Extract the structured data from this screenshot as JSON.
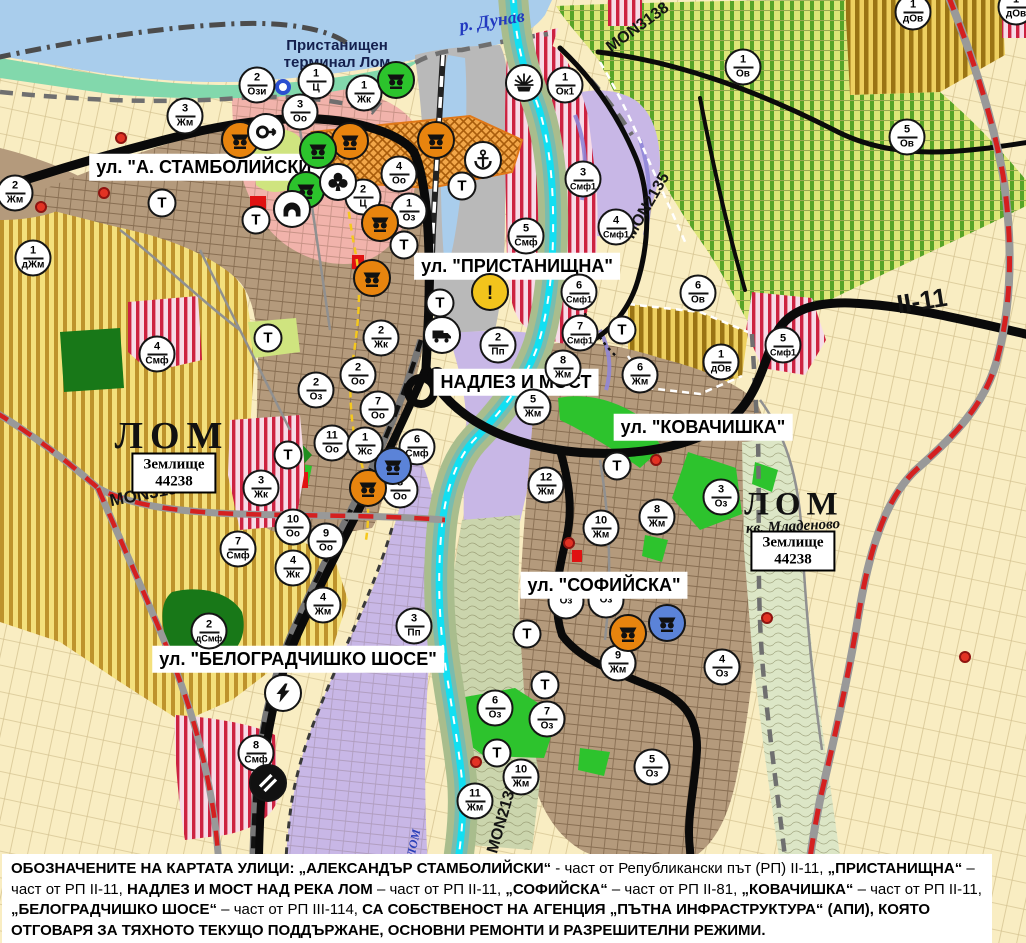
{
  "map": {
    "street_labels": [
      {
        "text": "ул. \"А. СТАМБОЛИЙСКИ\"",
        "x": 208,
        "y": 167
      },
      {
        "text": "ул. \"ПРИСТАНИЩНА\"",
        "x": 517,
        "y": 266
      },
      {
        "text": "НАДЛЕЗ И МОСТ",
        "x": 516,
        "y": 382
      },
      {
        "text": "ул. \"КОВАЧИШКА\"",
        "x": 703,
        "y": 427
      },
      {
        "text": "ул. \"СОФИЙСКА\"",
        "x": 604,
        "y": 585
      },
      {
        "text": "ул. \"БЕЛОГРАДЧИШКО ШОСЕ\"",
        "x": 298,
        "y": 659
      }
    ],
    "place_labels": [
      {
        "text": "р. Дунав",
        "x": 492,
        "y": 21,
        "rot": -9,
        "size": 18,
        "color": "#2239c0",
        "serif": true,
        "italic": true
      },
      {
        "text": "Пристанищен\nтерминал Лом",
        "x": 337,
        "y": 54,
        "rot": 0,
        "size": 15,
        "color": "#14204e",
        "serif": false,
        "italic": false
      },
      {
        "text": "ЛОМ",
        "x": 172,
        "y": 436,
        "rot": 0,
        "size": 38,
        "color": "#111111",
        "serif": true,
        "italic": false,
        "spacing": 7
      },
      {
        "text": "ЛОМ",
        "x": 794,
        "y": 505,
        "rot": 0,
        "size": 33,
        "color": "#111111",
        "serif": true,
        "italic": false,
        "spacing": 6
      },
      {
        "text": "кв. Младеново",
        "x": 793,
        "y": 527,
        "rot": -3,
        "size": 15,
        "color": "#111111",
        "serif": true,
        "italic": true
      },
      {
        "text": "ЛОМ",
        "x": 414,
        "y": 843,
        "rot": -78,
        "size": 12,
        "color": "#2a3fb8",
        "serif": true,
        "italic": true
      }
    ],
    "zemlishte_boxes": [
      {
        "lines": [
          "Землище",
          "44238"
        ],
        "x": 174,
        "y": 473
      },
      {
        "lines": [
          "Землище",
          "44238"
        ],
        "x": 793,
        "y": 551
      }
    ],
    "road_labels": [
      {
        "text": "MON3139",
        "x": 148,
        "y": 494,
        "rot": -11,
        "size": 17
      },
      {
        "text": "MON2135",
        "x": 648,
        "y": 206,
        "rot": -60,
        "size": 16
      },
      {
        "text": "MON3138",
        "x": 638,
        "y": 28,
        "rot": -36,
        "size": 16
      },
      {
        "text": "MON2136",
        "x": 503,
        "y": 818,
        "rot": -74,
        "size": 16
      },
      {
        "text": "II-11",
        "x": 922,
        "y": 301,
        "rot": -9,
        "size": 26
      }
    ],
    "t_label": "Т",
    "markers": [
      {
        "num": "2",
        "code": "Жм",
        "x": 15,
        "y": 193
      },
      {
        "num": "3",
        "code": "Жм",
        "x": 185,
        "y": 116
      },
      {
        "num": "2",
        "code": "Ози",
        "x": 257,
        "y": 85
      },
      {
        "num": "1",
        "code": "Ц",
        "x": 316,
        "y": 81
      },
      {
        "num": "3",
        "code": "Оо",
        "x": 300,
        "y": 112
      },
      {
        "num": "1",
        "code": "Жк",
        "x": 364,
        "y": 93
      },
      {
        "num": "1",
        "code": "Ок1",
        "x": 565,
        "y": 85
      },
      {
        "num": "1",
        "code": "дЖм",
        "x": 33,
        "y": 258
      },
      {
        "num": "4",
        "code": "Оо",
        "x": 399,
        "y": 174
      },
      {
        "num": "2",
        "code": "Ц",
        "x": 363,
        "y": 197
      },
      {
        "num": "1",
        "code": "Оз",
        "x": 409,
        "y": 211
      },
      {
        "num": "4",
        "code": "Смф",
        "x": 157,
        "y": 354
      },
      {
        "num": "5",
        "code": "Смф",
        "x": 526,
        "y": 236
      },
      {
        "num": "3",
        "code": "Смф1",
        "x": 583,
        "y": 179
      },
      {
        "num": "4",
        "code": "Смф1",
        "x": 616,
        "y": 227
      },
      {
        "num": "6",
        "code": "Смф1",
        "x": 579,
        "y": 292
      },
      {
        "num": "7",
        "code": "Смф1",
        "x": 580,
        "y": 333
      },
      {
        "num": "5",
        "code": "Смф1",
        "x": 783,
        "y": 345
      },
      {
        "num": "2",
        "code": "Жк",
        "x": 381,
        "y": 338
      },
      {
        "num": "2",
        "code": "Пп",
        "x": 498,
        "y": 345
      },
      {
        "num": "8",
        "code": "Жм",
        "x": 563,
        "y": 368
      },
      {
        "num": "5",
        "code": "Жм",
        "x": 533,
        "y": 407
      },
      {
        "num": "6",
        "code": "Жм",
        "x": 640,
        "y": 375
      },
      {
        "num": "12",
        "code": "Жм",
        "x": 546,
        "y": 485
      },
      {
        "num": "6",
        "code": "Смф",
        "x": 417,
        "y": 447
      },
      {
        "num": "8",
        "code": "Оо",
        "x": 400,
        "y": 490
      },
      {
        "num": "8",
        "code": "Жм",
        "x": 657,
        "y": 517
      },
      {
        "num": "10",
        "code": "Жм",
        "x": 601,
        "y": 528
      },
      {
        "num": "3",
        "code": "Оз",
        "x": 721,
        "y": 497
      },
      {
        "num": "2",
        "code": "Оз",
        "x": 316,
        "y": 390
      },
      {
        "num": "2",
        "code": "Оо",
        "x": 358,
        "y": 375
      },
      {
        "num": "7",
        "code": "Оо",
        "x": 378,
        "y": 409
      },
      {
        "num": "11",
        "code": "Оо",
        "x": 332,
        "y": 443
      },
      {
        "num": "1",
        "code": "Жс",
        "x": 365,
        "y": 445
      },
      {
        "num": "3",
        "code": "Жк",
        "x": 261,
        "y": 488
      },
      {
        "num": "10",
        "code": "Оо",
        "x": 293,
        "y": 527
      },
      {
        "num": "9",
        "code": "Оо",
        "x": 326,
        "y": 541
      },
      {
        "num": "4",
        "code": "Жк",
        "x": 293,
        "y": 568
      },
      {
        "num": "4",
        "code": "Жм",
        "x": 323,
        "y": 605
      },
      {
        "num": "2",
        "code": "дСмф",
        "x": 209,
        "y": 631
      },
      {
        "num": "7",
        "code": "Смф",
        "x": 238,
        "y": 549
      },
      {
        "num": "3",
        "code": "Пп",
        "x": 414,
        "y": 626
      },
      {
        "num": "8",
        "code": "Смф",
        "x": 256,
        "y": 753
      },
      {
        "num": "9",
        "code": "Жм",
        "x": 618,
        "y": 663
      },
      {
        "num": "4",
        "code": "Оз",
        "x": 722,
        "y": 667
      },
      {
        "num": "6",
        "code": "Оз",
        "x": 495,
        "y": 708
      },
      {
        "num": "7",
        "code": "Оз",
        "x": 547,
        "y": 719
      },
      {
        "num": "10",
        "code": "Жм",
        "x": 521,
        "y": 777
      },
      {
        "num": "11",
        "code": "Жм",
        "x": 475,
        "y": 801
      },
      {
        "num": "5",
        "code": "Оз",
        "x": 652,
        "y": 767
      },
      {
        "num": "1",
        "code": "Ов",
        "x": 743,
        "y": 67
      },
      {
        "num": "5",
        "code": "Ов",
        "x": 907,
        "y": 137
      },
      {
        "num": "6",
        "code": "Ов",
        "x": 698,
        "y": 293
      },
      {
        "num": "1",
        "code": "дОв",
        "x": 913,
        "y": 12
      },
      {
        "num": "1",
        "code": "дОв",
        "x": 721,
        "y": 362
      },
      {
        "num": "1",
        "code": "дОв",
        "x": 1016,
        "y": 7
      },
      {
        "num": "",
        "code": "Оз",
        "x": 566,
        "y": 601,
        "under": true
      },
      {
        "num": "",
        "code": "Оз",
        "x": 606,
        "y": 600,
        "under": true
      }
    ],
    "t_markers": [
      {
        "x": 162,
        "y": 203
      },
      {
        "x": 256,
        "y": 220
      },
      {
        "x": 268,
        "y": 338
      },
      {
        "x": 462,
        "y": 186
      },
      {
        "x": 404,
        "y": 245
      },
      {
        "x": 440,
        "y": 303
      },
      {
        "x": 622,
        "y": 330
      },
      {
        "x": 288,
        "y": 455
      },
      {
        "x": 617,
        "y": 466
      },
      {
        "x": 527,
        "y": 634
      },
      {
        "x": 545,
        "y": 685
      },
      {
        "x": 497,
        "y": 753
      }
    ],
    "icon_markers": [
      {
        "icon": "culture-monument",
        "fill": "#e8840e",
        "x": 240,
        "y": 140
      },
      {
        "icon": "culture-monument",
        "fill": "#e8840e",
        "x": 350,
        "y": 141
      },
      {
        "icon": "culture-monument",
        "fill": "#e8840e",
        "x": 436,
        "y": 140
      },
      {
        "icon": "culture-monument",
        "fill": "#e8840e",
        "x": 380,
        "y": 223
      },
      {
        "icon": "culture-monument",
        "fill": "#e8840e",
        "x": 372,
        "y": 278
      },
      {
        "icon": "culture-monument",
        "fill": "#e8840e",
        "x": 368,
        "y": 488
      },
      {
        "icon": "culture-monument",
        "fill": "#e8840e",
        "x": 628,
        "y": 633
      },
      {
        "icon": "culture-monument",
        "fill": "#2cc32c",
        "x": 396,
        "y": 80
      },
      {
        "icon": "culture-monument",
        "fill": "#2cc32c",
        "x": 318,
        "y": 150
      },
      {
        "icon": "culture-monument",
        "fill": "#2cc32c",
        "x": 306,
        "y": 190
      },
      {
        "icon": "culture-monument",
        "fill": "#5b83d8",
        "x": 393,
        "y": 466
      },
      {
        "icon": "culture-monument",
        "fill": "#5b83d8",
        "x": 667,
        "y": 623
      },
      {
        "icon": "circle-arrow",
        "fill": "#ffffff",
        "x": 266,
        "y": 132
      },
      {
        "icon": "cloverleaf",
        "fill": "#ffffff",
        "x": 338,
        "y": 182
      },
      {
        "icon": "tunnel",
        "fill": "#ffffff",
        "x": 292,
        "y": 209
      },
      {
        "icon": "anchor",
        "fill": "#ffffff",
        "x": 483,
        "y": 160
      },
      {
        "icon": "sun-rays",
        "fill": "#ffffff",
        "x": 524,
        "y": 83
      },
      {
        "icon": "warning",
        "fill": "#f2c41c",
        "x": 490,
        "y": 292
      },
      {
        "icon": "truck",
        "fill": "#ffffff",
        "x": 442,
        "y": 335
      },
      {
        "icon": "lightning",
        "fill": "#ffffff",
        "x": 283,
        "y": 693
      },
      {
        "icon": "rail-crossing",
        "fill": "#111111",
        "x": 268,
        "y": 783
      }
    ],
    "small_symbols": [
      {
        "type": "blue-ring",
        "x": 283,
        "y": 87
      },
      {
        "type": "red-dot",
        "x": 121,
        "y": 138
      },
      {
        "type": "red-dot",
        "x": 104,
        "y": 193
      },
      {
        "type": "red-dot",
        "x": 41,
        "y": 207
      },
      {
        "type": "red-dot",
        "x": 656,
        "y": 460
      },
      {
        "type": "red-dot",
        "x": 569,
        "y": 543
      },
      {
        "type": "red-dot",
        "x": 767,
        "y": 618
      },
      {
        "type": "red-dot",
        "x": 476,
        "y": 762
      },
      {
        "type": "red-dot",
        "x": 965,
        "y": 657
      }
    ],
    "footer_segments": [
      {
        "text": "ОБОЗНАЧЕНИТЕ НА КАРТАТА УЛИЦИ: „АЛЕКСАНДЪР СТАМБОЛИЙСКИ“",
        "bold": true
      },
      {
        "text": " - част от Републикански път (РП) II-11, ",
        "bold": false
      },
      {
        "text": "„ПРИСТАНИЩНА“",
        "bold": true
      },
      {
        "text": " – част от РП II-11, ",
        "bold": false
      },
      {
        "text": "НАДЛЕЗ И МОСТ НАД РЕКА ЛОМ",
        "bold": true
      },
      {
        "text": " – част от РП II-11, ",
        "bold": false
      },
      {
        "text": "„СОФИЙСКА“",
        "bold": true
      },
      {
        "text": " – част от РП II-81, ",
        "bold": false
      },
      {
        "text": "„КОВАЧИШКА“",
        "bold": true
      },
      {
        "text": " – част от РП II-11, ",
        "bold": false
      },
      {
        "text": "„БЕЛОГРАДЧИШКО ШОСЕ“",
        "bold": true
      },
      {
        "text": " – част от РП III-114, ",
        "bold": false
      },
      {
        "text": "СА СОБСТВЕНОСТ НА АГЕНЦИЯ „ПЪТНА ИНФРАСТРУКТУРА“ (АПИ), КОЯТО ОТГОВАРЯ ЗА ТЯХНОТО ТЕКУЩО ПОДДЪРЖАНЕ, ОСНОВНИ РЕМОНТИ И РАЗРЕШИТЕЛНИ РЕЖИМИ.",
        "bold": true
      }
    ],
    "palette": {
      "river": "#a9cdec",
      "canal": "#12dff2",
      "urban_brown": "#b49a7c",
      "salmon": "#f1b3ab",
      "lavender": "#c8b7e6",
      "port_gray": "#b9b9b9",
      "farm_yellow": "#f4e07c",
      "farm_green": "#dde678",
      "pale_yellow": "#f9edc2",
      "green_space": "#2dc32d",
      "dark_green": "#187818",
      "road_black": "#0a0a0a",
      "road_red_dash": "#d42020",
      "mint_shore": "#82d8ac"
    }
  }
}
